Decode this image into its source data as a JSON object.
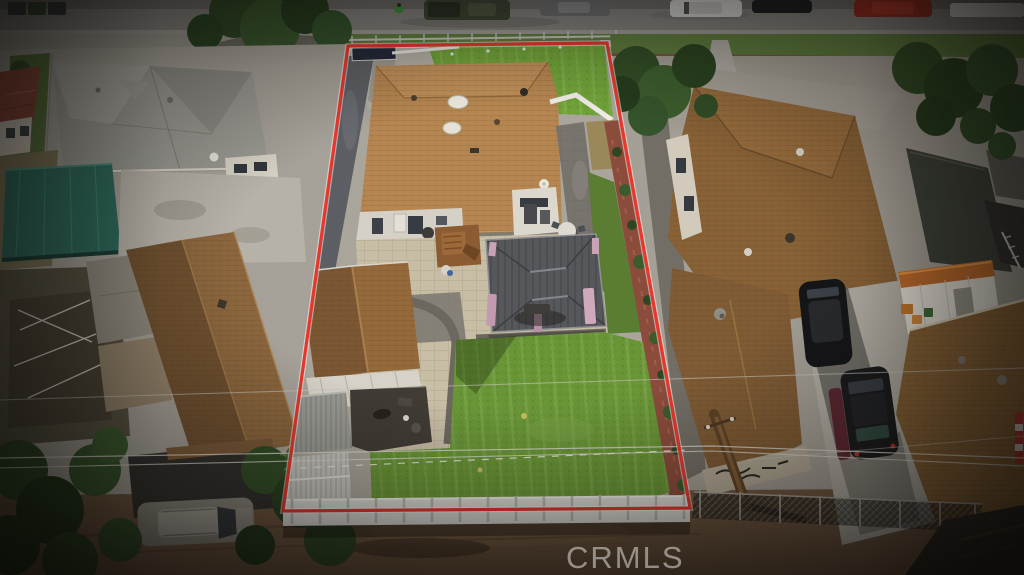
{
  "meta": {
    "type": "aerial-photograph",
    "subject": "drone view of a residential lot outlined in red, flanked by neighboring houses, street at top and dirt alley at bottom",
    "canvas": {
      "width": 1024,
      "height": 575
    }
  },
  "watermark": {
    "text": "CRMLS"
  },
  "colors": {
    "boundary_red": "#e8352b",
    "front_lawn": "#6fa237",
    "lawn": "#679434",
    "parkway": "#5d7c3c",
    "roof_tan": "#b5854f",
    "garage_roof": "#936839",
    "neighbor_roof_brown": "#876034",
    "neighbor_roof_gray": "#999992",
    "gazebo_gray": "#55565a",
    "fence_white": "#e0dfda",
    "teal_awning": "#2c6a5c",
    "street": "#85837f",
    "dirt": "#6f563f",
    "concrete": "#a9a59b",
    "paver": "#c8bda5",
    "shed_orange": "#c06a2a",
    "terracotta": "#8a4a3a"
  },
  "scene": {
    "objects": [
      "street-with-parked-cars",
      "subject-property",
      "main-house-tan-roof",
      "front-lawn",
      "backyard-lawn",
      "gray-gazebo-with-pink-curtains",
      "paver-patio",
      "detached-garage",
      "storage-sheds",
      "white-vinyl-fence",
      "red-property-boundary",
      "left-neighbor-gray-roof-house",
      "left-neighbor-brown-roof-house",
      "teal-awning",
      "right-neighbor-brown-roof-house",
      "driveway-with-black-cars",
      "white-shed-orange-roof",
      "utility-pole",
      "power-lines",
      "dirt-alley",
      "trees"
    ]
  }
}
